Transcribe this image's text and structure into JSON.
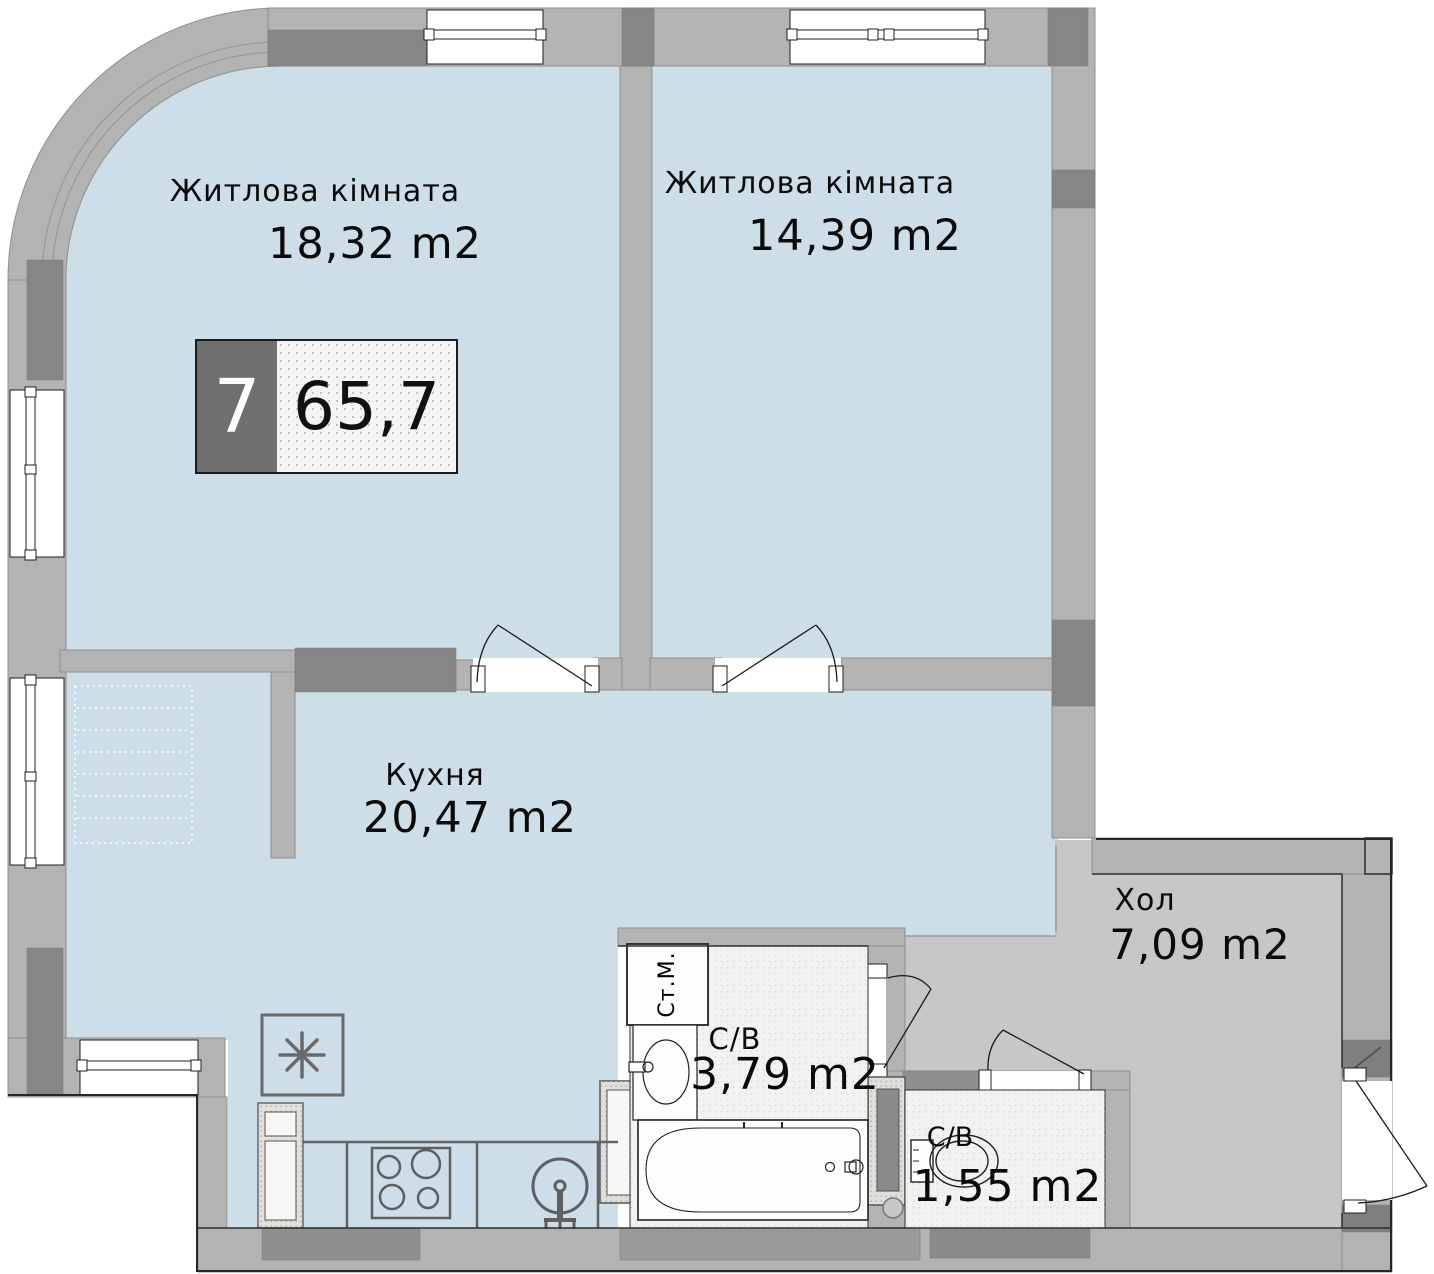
{
  "apartment": {
    "badge": {
      "number": "7",
      "total_area": "65,7"
    },
    "rooms": {
      "living_room_1": {
        "name": "Житлова кімната",
        "area": "18,32 m2"
      },
      "living_room_2": {
        "name": "Житлова кімната",
        "area": "14,39 m2"
      },
      "kitchen": {
        "name": "Кухня",
        "area": "20,47 m2"
      },
      "hall": {
        "name": "Хол",
        "area": "7,09 m2"
      },
      "bathroom": {
        "name": "С/В",
        "area": "3,79 m2"
      },
      "wc": {
        "name": "С/В",
        "area": "1,55 m2"
      }
    },
    "fixtures": {
      "washing_machine_label": "Ст.М.",
      "icons": [
        "ventilation-icon",
        "fridge-icon",
        "stove-icon",
        "kitchen-sink-icon",
        "washbasin-icon",
        "bathtub-icon",
        "toilet-icon",
        "washing-machine-icon",
        "door-arc-icon",
        "window-icon"
      ]
    },
    "colors": {
      "room_floor": "#cddee9",
      "hall_floor": "#c7c7c7",
      "bath_floor": "#f2f2f0",
      "wall": "#b3b3b3",
      "column": "#868686",
      "badge_dark": "#6f6f6f",
      "outline": "#1a1a1a"
    }
  }
}
